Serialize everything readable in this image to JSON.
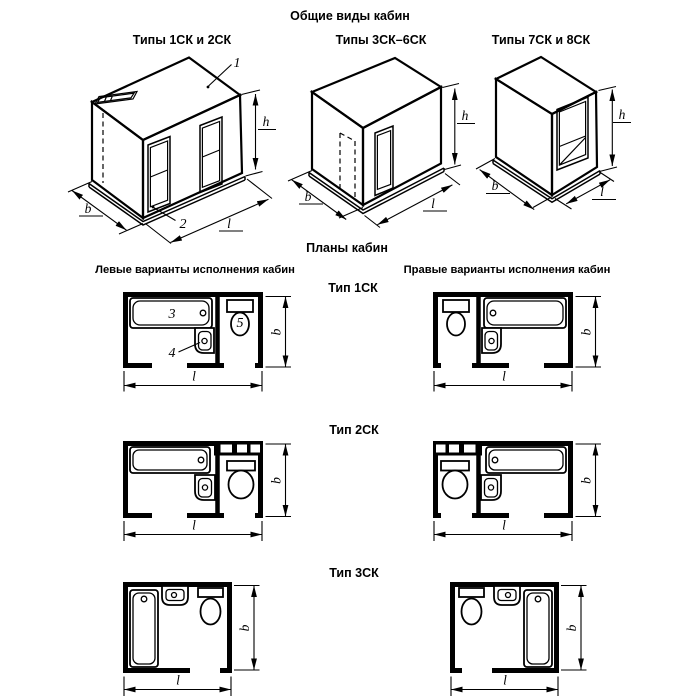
{
  "titles": {
    "general_views": "Общие виды кабин",
    "plans": "Планы кабин",
    "left_variants": "Левые варианты исполнения кабин",
    "right_variants": "Правые варианты исполнения кабин"
  },
  "iso_captions": [
    "Типы 1СК и 2СК",
    "Типы 3СК–6СК",
    "Типы 7СК и 8СК"
  ],
  "plan_type_labels": [
    "Тип 1СК",
    "Тип 2СК",
    "Тип 3СК"
  ],
  "callouts": {
    "roof_panel": "1",
    "base": "2",
    "bathtub": "3",
    "washbasin": "4",
    "toilet": "5"
  },
  "dim_labels": {
    "width": "b",
    "length": "l",
    "height": "h"
  },
  "colors": {
    "ink": "#000000",
    "paper": "#ffffff"
  }
}
